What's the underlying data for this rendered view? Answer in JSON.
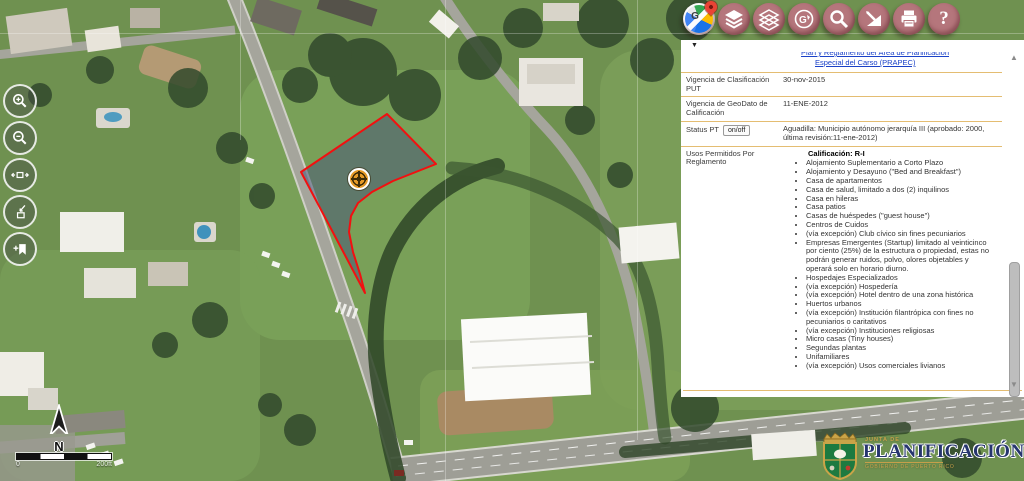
{
  "toolbar": {
    "google_glyph": "G",
    "help_glyph": "?",
    "buttons": [
      {
        "icon": "google-maps-basemap"
      },
      {
        "icon": "layers-solid"
      },
      {
        "icon": "layers-outline"
      },
      {
        "icon": "globe-tools"
      },
      {
        "icon": "search"
      },
      {
        "icon": "draw-measure"
      },
      {
        "icon": "print"
      },
      {
        "icon": "help"
      }
    ]
  },
  "map_controls": {
    "zoom_in": "zoom-in",
    "zoom_out": "zoom-out",
    "extent": "extent-arrows",
    "identify": "identify-select",
    "bookmark": "add-bookmark"
  },
  "map": {
    "north_label": "N",
    "scale_left_label": "0",
    "scale_right_label": "200ft"
  },
  "panel": {
    "collapse_icon": "▼",
    "scroll_up": "▲",
    "scroll_down": "▼",
    "link": {
      "line1_clipped": "Plan y Reglamento del Área de Planificación",
      "line2": "Especial del Carso (PRAPEC)"
    },
    "rows": [
      {
        "label": "Vigencia de Clasificación PUT",
        "value": "30-nov-2015"
      },
      {
        "label": "Vigencia de GeoDato de Calificación",
        "value": "11-ENE-2012"
      },
      {
        "label": "Status PT",
        "toggle": "on/off",
        "value": "Aguadilla: Municipio autónomo jerarquía III (aprobado: 2000, última revisión:11-ene-2012)"
      }
    ],
    "usos": {
      "label": "Usos Permitidos Por Reglamento",
      "title": "Calificación: R-I",
      "items": [
        "Alojamiento Suplementario a Corto Plazo",
        "Alojamiento y Desayuno (\"Bed and Breakfast\")",
        "Casa de apartamentos",
        "Casa de salud, limitado a dos (2) inquilinos",
        "Casa en hileras",
        "Casa patios",
        "Casas de huéspedes (\"guest house\")",
        "Centros de Cuidos",
        "(vía excepción) Club cívico sin fines pecuniarios",
        "Empresas Emergentes (Startup) limitado al veinticinco por ciento (25%) de la estructura o propiedad, estas no podrán generar ruidos, polvo, olores objetables y operará solo en horario diurno.",
        "Hospedajes Especializados",
        "(vía excepción) Hospedería",
        "(vía excepción) Hotel dentro de una zona histórica",
        "Huertos urbanos",
        "(vía excepción) Institución filantrópica con fines no pecuniarios o caritativos",
        "(vía excepción) Instituciones religiosas",
        "Micro casas (Tiny houses)",
        "Segundas plantas",
        "Unifamiliares",
        "(vía excepción) Usos comerciales livianos"
      ]
    }
  },
  "logo": {
    "junta": "JUNTA DE",
    "name": "PLANIFICACIÓN",
    "gobierno": "GOBIERNO DE PUERTO RICO"
  },
  "colors": {
    "toolbar_button": "#b5767c",
    "panel_divider": "#e4bd72",
    "link": "#1a41c8",
    "parcel_outline": "#f21010",
    "parcel_fill": "#4a587a",
    "marker": "#e59a28",
    "logo_navy": "#26356e",
    "logo_gold": "#c8a14b"
  }
}
